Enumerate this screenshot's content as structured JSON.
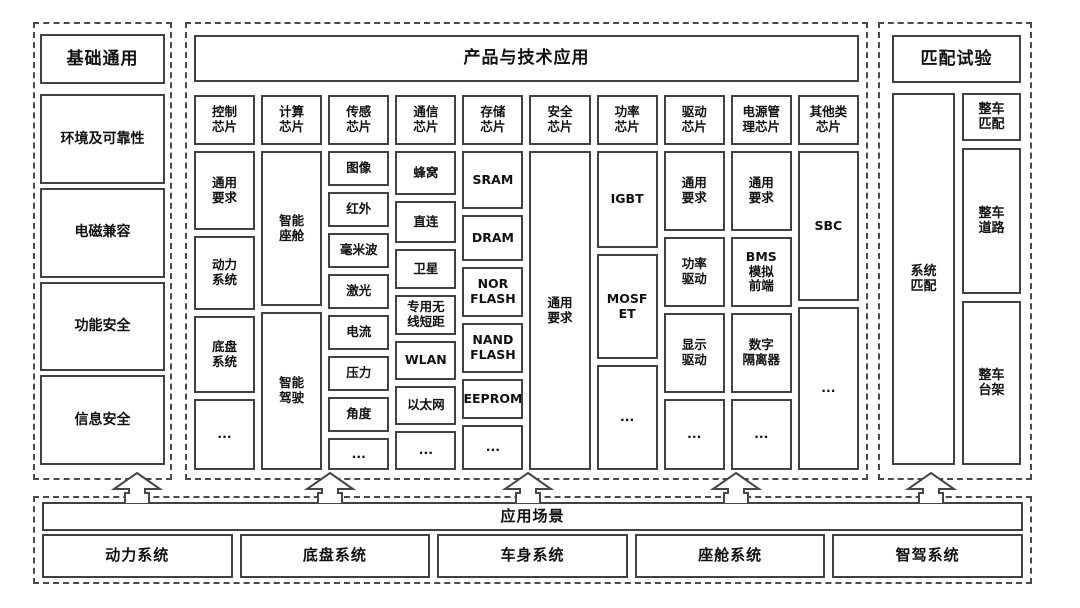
{
  "colors": {
    "solid_border": "#414141",
    "dashed_border": "#4a4a4a",
    "text": "#111111",
    "background": "#ffffff"
  },
  "left_panel": {
    "title": "基础通用",
    "items": [
      "环境及可靠性",
      "电磁兼容",
      "功能安全",
      "信息安全"
    ]
  },
  "center_panel": {
    "title": "产品与技术应用",
    "columns": [
      {
        "header": "控制\n芯片",
        "items": [
          "通用\n要求",
          "动力\n系统",
          "底盘\n系统",
          "..."
        ]
      },
      {
        "header": "计算\n芯片",
        "items": [
          "智能\n座舱",
          "智能\n驾驶"
        ]
      },
      {
        "header": "传感\n芯片",
        "items": [
          "图像",
          "红外",
          "毫米波",
          "激光",
          "电流",
          "压力",
          "角度",
          "..."
        ]
      },
      {
        "header": "通信\n芯片",
        "items": [
          "蜂窝",
          "直连",
          "卫星",
          "专用无\n线短距",
          "WLAN",
          "以太网",
          "..."
        ]
      },
      {
        "header": "存储\n芯片",
        "items": [
          "SRAM",
          "DRAM",
          "NOR\nFLASH",
          "NAND\nFLASH",
          "EEPROM",
          "..."
        ]
      },
      {
        "header": "安全\n芯片",
        "items": [
          "通用\n要求"
        ]
      },
      {
        "header": "功率\n芯片",
        "items": [
          "IGBT",
          "MOSF\nET",
          "..."
        ]
      },
      {
        "header": "驱动\n芯片",
        "items": [
          "通用\n要求",
          "功率\n驱动",
          "显示\n驱动",
          "..."
        ]
      },
      {
        "header": "电源管\n理芯片",
        "items": [
          "通用\n要求",
          "BMS\n模拟\n前端",
          "数字\n隔离器",
          "..."
        ]
      },
      {
        "header": "其他类\n芯片",
        "items": [
          "SBC",
          "..."
        ]
      }
    ]
  },
  "right_panel": {
    "title": "匹配试验",
    "system_item": "系统\n匹配",
    "items": [
      "整车\n匹配",
      "整车\n道路",
      "整车\n台架"
    ]
  },
  "bottom_panel": {
    "title": "应用场景",
    "items": [
      "动力系统",
      "底盘系统",
      "车身系统",
      "座舱系统",
      "智驾系统"
    ]
  },
  "arrows": {
    "count": 5,
    "direction": "up"
  }
}
